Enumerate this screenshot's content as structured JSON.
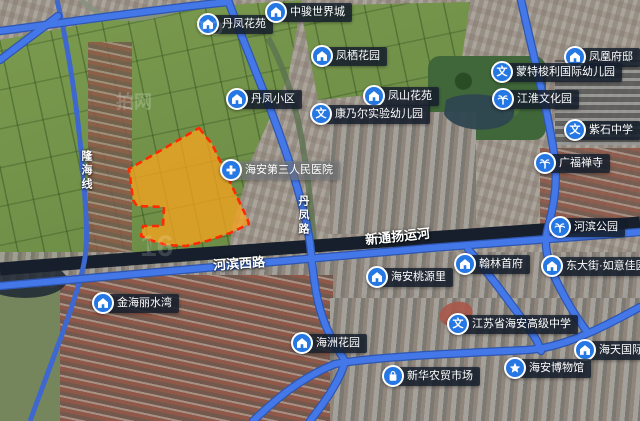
{
  "map_name": "satellite-map-with-parcel",
  "parcel": {
    "fill": "#f9a41e",
    "stroke": "#ff2a00",
    "fill_opacity": "0.75"
  },
  "colors": {
    "poi_icon_bg": "#2577e3",
    "poi_label_bg": "rgba(22,32,46,0.82)",
    "road": "#4478e8",
    "road_casing": "#2f56b0",
    "river": "#161f2b",
    "railway": "#3e68cf"
  },
  "pois": [
    {
      "id": "danfeng-huayuan",
      "label": "丹凤花苑",
      "icon": "house",
      "x": 208,
      "y": 24
    },
    {
      "id": "zhongjun-world-city",
      "label": "中骏世界城",
      "icon": "house",
      "x": 276,
      "y": 12
    },
    {
      "id": "fengqi-garden",
      "label": "凤栖花园",
      "icon": "house",
      "x": 322,
      "y": 56
    },
    {
      "id": "fenghuang-mansion",
      "label": "凤凰府邸",
      "icon": "house",
      "x": 575,
      "y": 57
    },
    {
      "id": "danfeng-community",
      "label": "丹凤小区",
      "icon": "house",
      "x": 237,
      "y": 99
    },
    {
      "id": "fengshan-garden",
      "label": "凤山花苑",
      "icon": "house",
      "x": 374,
      "y": 96
    },
    {
      "id": "kangnaier-kindergarten",
      "label": "康乃尔实验幼儿园",
      "icon": "school",
      "x": 321,
      "y": 114
    },
    {
      "id": "montessori-kindergarten",
      "label": "蒙特梭利国际幼儿园",
      "icon": "school",
      "x": 502,
      "y": 72
    },
    {
      "id": "jianghuai-culture-park",
      "label": "江淮文化园",
      "icon": "tree",
      "x": 503,
      "y": 99
    },
    {
      "id": "zishi-middle-school",
      "label": "紫石中学",
      "icon": "school",
      "x": 575,
      "y": 130
    },
    {
      "id": "guangfu-temple",
      "label": "广福禅寺",
      "icon": "tree",
      "x": 545,
      "y": 163
    },
    {
      "id": "haian-third-hospital",
      "label": "海安第三人民医院",
      "icon": "hospital",
      "x": 231,
      "y": 170,
      "variant": "light"
    },
    {
      "id": "hebin-park",
      "label": "河滨公园",
      "icon": "tree",
      "x": 560,
      "y": 227
    },
    {
      "id": "haian-taoyuanli",
      "label": "海安桃源里",
      "icon": "house",
      "x": 377,
      "y": 277
    },
    {
      "id": "hanlin-shoufu",
      "label": "翰林首府",
      "icon": "house",
      "x": 465,
      "y": 264
    },
    {
      "id": "dongdajie-ruyi",
      "label": "东大街·如意佳园",
      "icon": "house",
      "x": 552,
      "y": 266
    },
    {
      "id": "jinhai-lishuiwan",
      "label": "金海丽水湾",
      "icon": "house",
      "x": 103,
      "y": 303
    },
    {
      "id": "haizhou-garden",
      "label": "海洲花园",
      "icon": "house",
      "x": 302,
      "y": 343
    },
    {
      "id": "haian-high-school",
      "label": "江苏省海安高级中学",
      "icon": "school",
      "x": 458,
      "y": 324
    },
    {
      "id": "haitian-international",
      "label": "海天国际",
      "icon": "house",
      "x": 585,
      "y": 350
    },
    {
      "id": "haian-museum",
      "label": "海安博物馆",
      "icon": "star",
      "x": 515,
      "y": 368
    },
    {
      "id": "xinhua-market",
      "label": "新华农贸市场",
      "icon": "shopping-bag",
      "x": 393,
      "y": 376
    }
  ],
  "road_labels": [
    {
      "text": "隆海线",
      "x": 78,
      "y": 150,
      "vertical": true,
      "size": 11
    },
    {
      "text": "丹凤路",
      "x": 295,
      "y": 195,
      "vertical": true,
      "size": 11
    },
    {
      "text": "河滨西路",
      "x": 213,
      "y": 253,
      "vertical": false,
      "size": 13,
      "rotate": -4
    },
    {
      "text": "新通扬运河",
      "x": 365,
      "y": 226,
      "vertical": false,
      "size": 13,
      "rotate": -6
    }
  ],
  "watermarks": [
    {
      "text": "拍网",
      "x": 116,
      "y": 88,
      "size": 18,
      "color": "rgba(255,255,255,0.20)"
    },
    {
      "text": "16",
      "x": 140,
      "y": 230,
      "size": 30,
      "color": "rgba(255,255,255,0.16)"
    },
    {
      "text": "TO",
      "x": 196,
      "y": 18,
      "size": 20,
      "color": "rgba(255,255,255,0.14)"
    }
  ]
}
